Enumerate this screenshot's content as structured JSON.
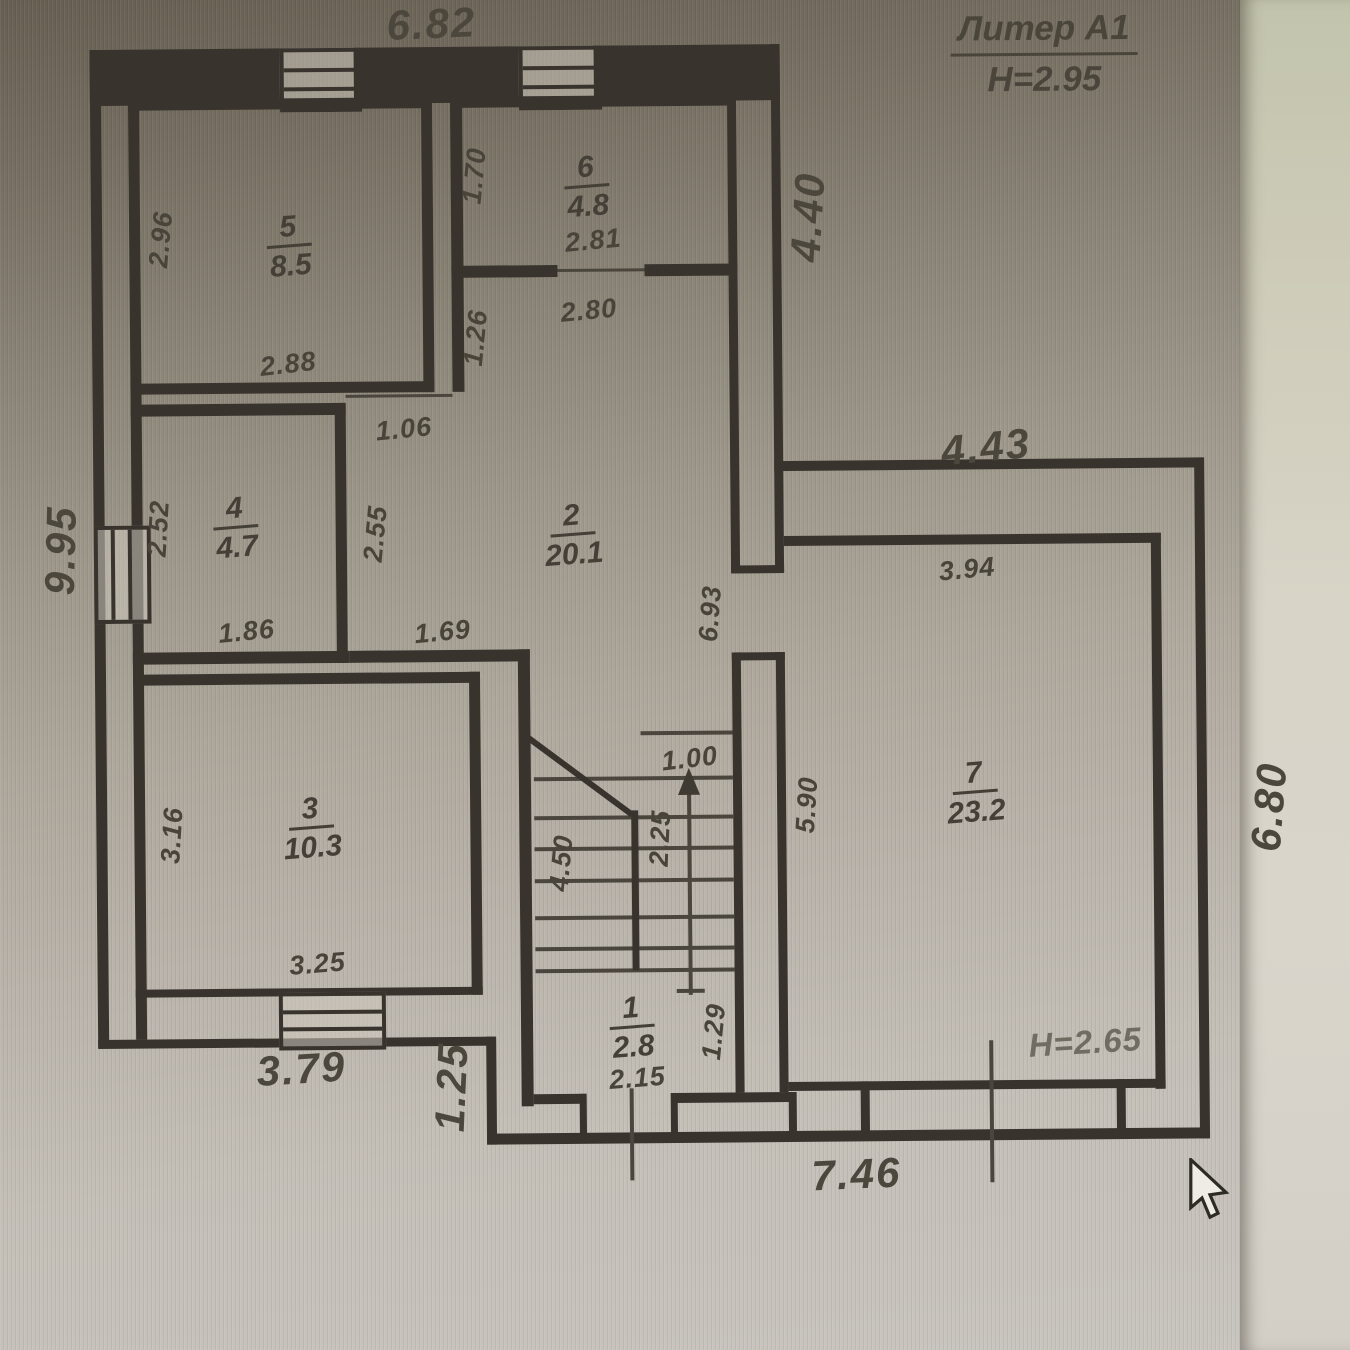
{
  "title": {
    "liter": "Литер А1",
    "height": "Н=2.95"
  },
  "rooms": [
    {
      "number": "1",
      "area": "2.8"
    },
    {
      "number": "2",
      "area": "20.1"
    },
    {
      "number": "3",
      "area": "10.3"
    },
    {
      "number": "4",
      "area": "4.7"
    },
    {
      "number": "5",
      "area": "8.5"
    },
    {
      "number": "6",
      "area": "4.8"
    },
    {
      "number": "7",
      "area": "23.2"
    }
  ],
  "room7_ceiling": "H=2.65",
  "dims": {
    "top": "6.82",
    "left": "9.95",
    "right_upper": "4.40",
    "ext_top": "4.43",
    "ext_right": "6.80",
    "bottom_left": "3.79",
    "step": "1.25",
    "bottom": "7.46",
    "r5_h": "2.96",
    "r5_w": "2.88",
    "r6_h": "1.70",
    "r6_w": "2.81",
    "r2_top": "2.80",
    "r2_left": "1.26",
    "corridor_door": "1.06",
    "r4_h": "2.52",
    "corridor_h": "2.55",
    "r4_w": "1.86",
    "hall_wall": "1.69",
    "r3_h": "3.16",
    "r3_w": "3.25",
    "r2_right": "6.93",
    "r7_left": "5.90",
    "r7_top": "3.94",
    "stair_len": "4.50",
    "stair_w": "2.25",
    "stair_top": "1.00",
    "r1_right": "1.29",
    "r1_w": "2.15"
  }
}
